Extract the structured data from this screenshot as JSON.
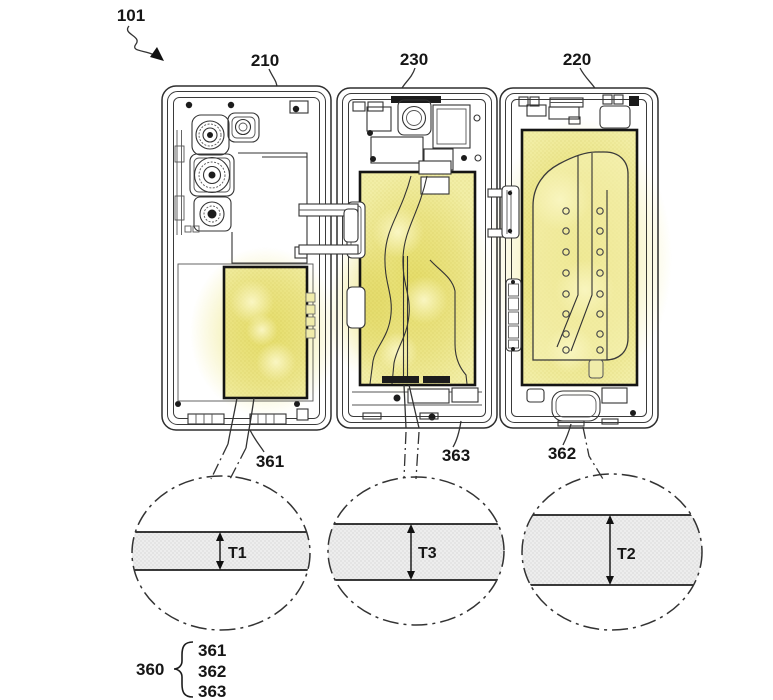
{
  "figure": {
    "title_refs": {
      "assembly": "101",
      "panels": {
        "left": "210",
        "middle": "230",
        "right": "220"
      }
    },
    "batteries": {
      "left": {
        "label": "361",
        "thickness": "T1"
      },
      "middle": {
        "label": "363",
        "thickness": "T3"
      },
      "right": {
        "label": "362",
        "thickness": "T2"
      }
    },
    "legend": {
      "group": "360",
      "members": [
        "361",
        "362",
        "363"
      ]
    },
    "colors": {
      "highlight_yellow": "#f2eea6",
      "glow_yellow": "#f1eb9a",
      "line_dark": "#2e2e2e",
      "band_gray": "#ededed",
      "background": "#ffffff"
    }
  }
}
